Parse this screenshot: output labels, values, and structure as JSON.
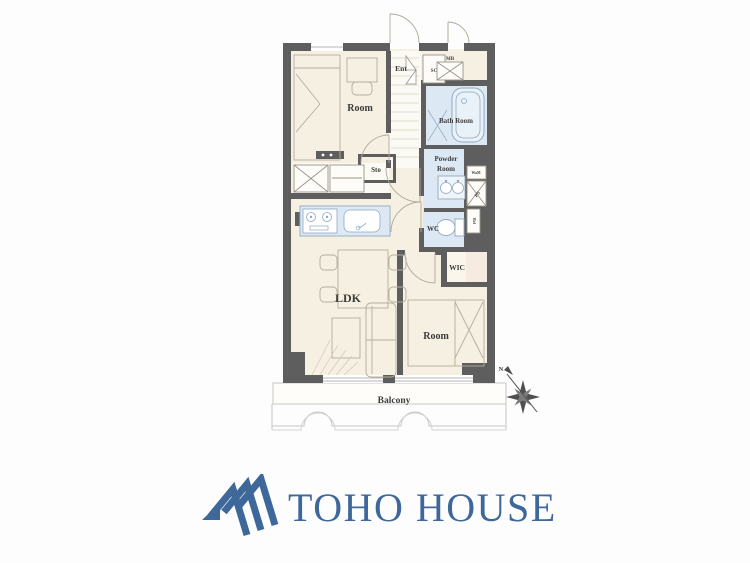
{
  "floorplan": {
    "rooms": {
      "room_top": "Room",
      "room_bottom": "Room",
      "ldk": "LDK",
      "bath": "Bath Room",
      "powder_line1": "Powder",
      "powder_line2": "Room",
      "wc": "WC",
      "wic": "WIC",
      "sto": "Sto",
      "ent": "Ent",
      "sc": "SC",
      "mb": "MB",
      "ps": "PS",
      "wam": "WaM",
      "ref": "Ref",
      "balcony": "Balcony"
    },
    "compass": {
      "north": "N"
    },
    "colors": {
      "wall": "#5f5e5e",
      "floor": "#f6f0e2",
      "hall": "#fbfaf4",
      "wet_area": "#dce8f4",
      "wic_floor": "#f5ebe1",
      "furniture_line": "#b5ad9d",
      "fixture_line": "#8fa9c2",
      "label": "#3c3c3c",
      "balcony_line": "#c6c6c6"
    }
  },
  "logo": {
    "text": "TOHO HOUSE",
    "color": "#3d6899"
  }
}
